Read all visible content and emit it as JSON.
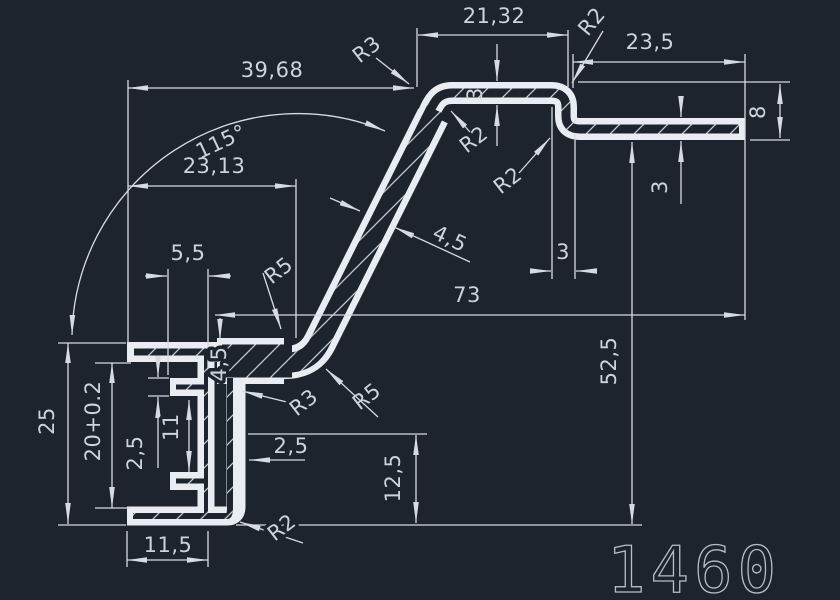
{
  "drawing": {
    "part_number": "1460",
    "colors": {
      "background": "#1e242e",
      "profile_line": "#e9edf1",
      "dimension_line": "#d6dbe2",
      "text": "#ccd3db"
    },
    "dimensions": {
      "top_flat_width": "21,32",
      "right_arm_length": "23,5",
      "upper_left_width": "39,68",
      "bend_angle": "115°",
      "mid_width": "23,13",
      "tooth_depth": "5,5",
      "total_width": "73",
      "right_height": "52,5",
      "channel_outer_height": "25",
      "channel_inner_height": "20+0.2",
      "tooth_gap": "11",
      "tooth_thickness": "2,5",
      "wall_thickness": "2,5",
      "lower_right_height": "12,5",
      "bottom_flange_width": "11,5",
      "diag_wall_thickness": "4,5",
      "junction_thickness": "4,5",
      "top_wall_thickness": "3",
      "arm_thickness": "3",
      "step_offset": "3",
      "arm_total_height": "8"
    },
    "radii": {
      "r3_top_bend": "R3",
      "r2_top_right": "R2",
      "r2_bend_inner": "R2",
      "r2_step_inner": "R2",
      "r5_upper_bend": "R5",
      "r5_lower_bend": "R5",
      "r3_web_inner": "R3",
      "r2_bottom_corner": "R2"
    }
  }
}
